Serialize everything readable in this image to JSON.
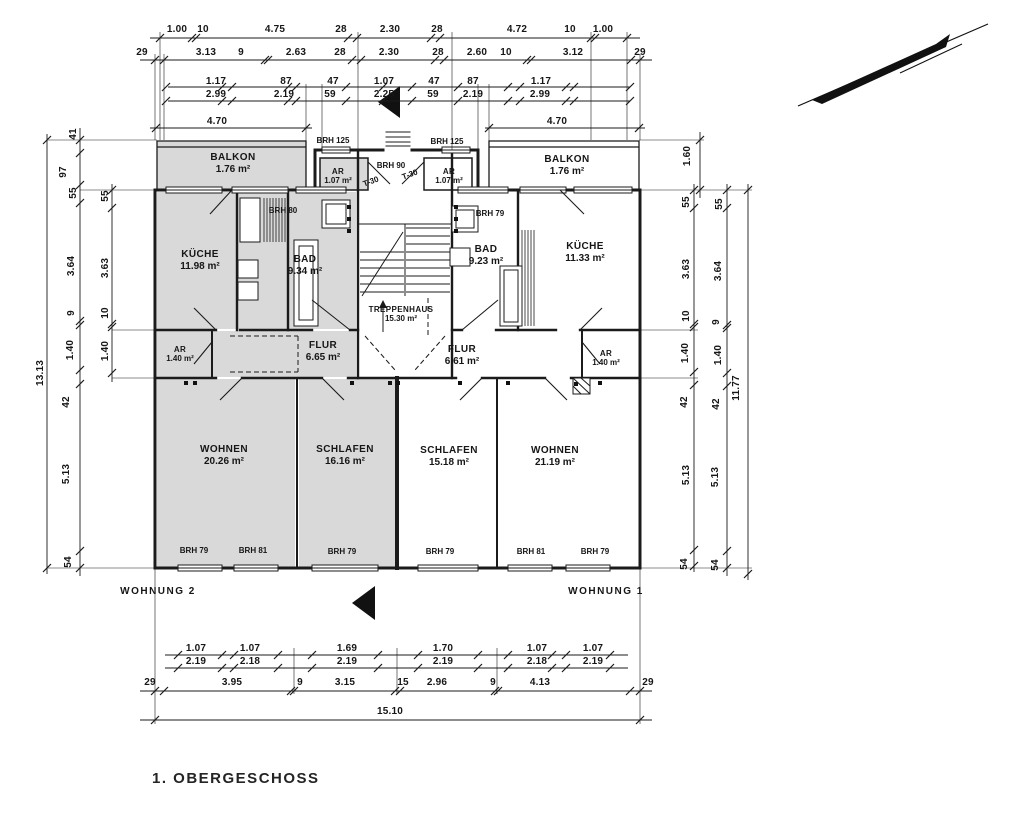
{
  "title": "1. OBERGESCHOSS",
  "colors": {
    "shaded": "#d9d9d9",
    "line": "#1b1b1b",
    "background": "#ffffff"
  },
  "apartment_labels": [
    {
      "text": "WOHNUNG 2",
      "x": 158,
      "y": 592
    },
    {
      "text": "WOHNUNG 1",
      "x": 606,
      "y": 592
    }
  ],
  "rooms": [
    {
      "id": "balkon-left",
      "name": "BALKON",
      "area": "1.76 m²",
      "x": 233,
      "y": 158
    },
    {
      "id": "balkon-right",
      "name": "BALKON",
      "area": "1.76 m²",
      "x": 567,
      "y": 160
    },
    {
      "id": "ar-top-left",
      "name": "AR",
      "area": "1.07 m²",
      "x": 338,
      "y": 170,
      "small": true
    },
    {
      "id": "ar-top-right",
      "name": "AR",
      "area": "1.07 m²",
      "x": 449,
      "y": 170,
      "small": true
    },
    {
      "id": "kueche-left",
      "name": "KÜCHE",
      "area": "11.98 m²",
      "x": 200,
      "y": 255
    },
    {
      "id": "bad-left",
      "name": "BAD",
      "area": "9.34 m²",
      "x": 305,
      "y": 260
    },
    {
      "id": "treppenhaus",
      "name": "TREPPENHAUS",
      "area": "15.30 m²",
      "x": 401,
      "y": 308,
      "small": true
    },
    {
      "id": "bad-right",
      "name": "BAD",
      "area": "9.23 m²",
      "x": 486,
      "y": 250
    },
    {
      "id": "kueche-right",
      "name": "KÜCHE",
      "area": "11.33 m²",
      "x": 585,
      "y": 247
    },
    {
      "id": "ar-mid-left",
      "name": "AR",
      "area": "1.40 m²",
      "x": 180,
      "y": 348,
      "small": true
    },
    {
      "id": "flur-left",
      "name": "FLUR",
      "area": "6.65 m²",
      "x": 323,
      "y": 346
    },
    {
      "id": "flur-right",
      "name": "FLUR",
      "area": "6.61 m²",
      "x": 462,
      "y": 350
    },
    {
      "id": "ar-mid-right",
      "name": "AR",
      "area": "1.40 m²",
      "x": 606,
      "y": 352,
      "small": true
    },
    {
      "id": "wohnen-left",
      "name": "WOHNEN",
      "area": "20.26 m²",
      "x": 224,
      "y": 450
    },
    {
      "id": "schlafen-left",
      "name": "SCHLAFEN",
      "area": "16.16 m²",
      "x": 345,
      "y": 450
    },
    {
      "id": "schlafen-right",
      "name": "SCHLAFEN",
      "area": "15.18 m²",
      "x": 449,
      "y": 451
    },
    {
      "id": "wohnen-right",
      "name": "WOHNEN",
      "area": "21.19 m²",
      "x": 555,
      "y": 451
    }
  ],
  "annotations": [
    {
      "text": "BRH 125",
      "x": 333,
      "y": 141
    },
    {
      "text": "BRH 125",
      "x": 447,
      "y": 142
    },
    {
      "text": "BRH 90",
      "x": 391,
      "y": 166
    },
    {
      "text": "T-30",
      "x": 371,
      "y": 182,
      "r": -20
    },
    {
      "text": "T-30",
      "x": 410,
      "y": 175,
      "r": -20
    },
    {
      "text": "BRH 80",
      "x": 283,
      "y": 211
    },
    {
      "text": "BRH 79",
      "x": 490,
      "y": 214
    },
    {
      "text": "BRH 79",
      "x": 194,
      "y": 551
    },
    {
      "text": "BRH 81",
      "x": 253,
      "y": 551
    },
    {
      "text": "BRH 79",
      "x": 342,
      "y": 552
    },
    {
      "text": "BRH 79",
      "x": 440,
      "y": 552
    },
    {
      "text": "BRH 81",
      "x": 531,
      "y": 552
    },
    {
      "text": "BRH 79",
      "x": 595,
      "y": 552
    }
  ],
  "dim_labels": [
    {
      "t": "1.00",
      "x": 177,
      "y": 30
    },
    {
      "t": "10",
      "x": 203,
      "y": 30
    },
    {
      "t": "4.75",
      "x": 275,
      "y": 30
    },
    {
      "t": "28",
      "x": 341,
      "y": 30
    },
    {
      "t": "2.30",
      "x": 390,
      "y": 30
    },
    {
      "t": "28",
      "x": 437,
      "y": 30
    },
    {
      "t": "4.72",
      "x": 517,
      "y": 30
    },
    {
      "t": "10",
      "x": 570,
      "y": 30
    },
    {
      "t": "1.00",
      "x": 603,
      "y": 30
    },
    {
      "t": "29",
      "x": 142,
      "y": 53
    },
    {
      "t": "3.13",
      "x": 206,
      "y": 53
    },
    {
      "t": "9",
      "x": 241,
      "y": 53
    },
    {
      "t": "2.63",
      "x": 296,
      "y": 53
    },
    {
      "t": "28",
      "x": 340,
      "y": 53
    },
    {
      "t": "2.30",
      "x": 389,
      "y": 53
    },
    {
      "t": "28",
      "x": 438,
      "y": 53
    },
    {
      "t": "2.60",
      "x": 477,
      "y": 53
    },
    {
      "t": "10",
      "x": 506,
      "y": 53
    },
    {
      "t": "3.12",
      "x": 573,
      "y": 53
    },
    {
      "t": "29",
      "x": 640,
      "y": 53
    },
    {
      "t": "1.17",
      "x": 216,
      "y": 82
    },
    {
      "t": "87",
      "x": 286,
      "y": 82
    },
    {
      "t": "47",
      "x": 333,
      "y": 82
    },
    {
      "t": "1.07",
      "x": 384,
      "y": 82
    },
    {
      "t": "47",
      "x": 434,
      "y": 82
    },
    {
      "t": "87",
      "x": 473,
      "y": 82
    },
    {
      "t": "1.17",
      "x": 541,
      "y": 82
    },
    {
      "t": "2.99",
      "x": 216,
      "y": 95
    },
    {
      "t": "2.19",
      "x": 284,
      "y": 95
    },
    {
      "t": "59",
      "x": 330,
      "y": 95
    },
    {
      "t": "2.25",
      "x": 384,
      "y": 95
    },
    {
      "t": "59",
      "x": 433,
      "y": 95
    },
    {
      "t": "2.19",
      "x": 473,
      "y": 95
    },
    {
      "t": "2.99",
      "x": 540,
      "y": 95
    },
    {
      "t": "4.70",
      "x": 217,
      "y": 122
    },
    {
      "t": "4.70",
      "x": 557,
      "y": 122
    },
    {
      "t": "1.07",
      "x": 196,
      "y": 649
    },
    {
      "t": "1.07",
      "x": 250,
      "y": 649
    },
    {
      "t": "1.69",
      "x": 347,
      "y": 649
    },
    {
      "t": "1.70",
      "x": 443,
      "y": 649
    },
    {
      "t": "1.07",
      "x": 537,
      "y": 649
    },
    {
      "t": "1.07",
      "x": 593,
      "y": 649
    },
    {
      "t": "2.19",
      "x": 196,
      "y": 662
    },
    {
      "t": "2.18",
      "x": 250,
      "y": 662
    },
    {
      "t": "2.19",
      "x": 347,
      "y": 662
    },
    {
      "t": "2.19",
      "x": 443,
      "y": 662
    },
    {
      "t": "2.18",
      "x": 537,
      "y": 662
    },
    {
      "t": "2.19",
      "x": 593,
      "y": 662
    },
    {
      "t": "29",
      "x": 150,
      "y": 683
    },
    {
      "t": "3.95",
      "x": 232,
      "y": 683
    },
    {
      "t": "9",
      "x": 300,
      "y": 683
    },
    {
      "t": "3.15",
      "x": 345,
      "y": 683
    },
    {
      "t": "15",
      "x": 403,
      "y": 683
    },
    {
      "t": "2.96",
      "x": 437,
      "y": 683
    },
    {
      "t": "9",
      "x": 493,
      "y": 683
    },
    {
      "t": "4.13",
      "x": 540,
      "y": 683
    },
    {
      "t": "29",
      "x": 648,
      "y": 683
    },
    {
      "t": "15.10",
      "x": 390,
      "y": 712
    },
    {
      "t": "41",
      "x": 74,
      "y": 134,
      "r": -90
    },
    {
      "t": "97",
      "x": 64,
      "y": 172,
      "r": -90
    },
    {
      "t": "55",
      "x": 74,
      "y": 193,
      "r": -90
    },
    {
      "t": "3.64",
      "x": 72,
      "y": 266,
      "r": -90
    },
    {
      "t": "9",
      "x": 72,
      "y": 313,
      "r": -90
    },
    {
      "t": "1.40",
      "x": 71,
      "y": 350,
      "r": -90
    },
    {
      "t": "42",
      "x": 67,
      "y": 402,
      "r": -90
    },
    {
      "t": "5.13",
      "x": 67,
      "y": 474,
      "r": -90
    },
    {
      "t": "54",
      "x": 69,
      "y": 562,
      "r": -90
    },
    {
      "t": "13.13",
      "x": 41,
      "y": 373,
      "r": -90
    },
    {
      "t": "55",
      "x": 106,
      "y": 196,
      "r": -90
    },
    {
      "t": "3.63",
      "x": 106,
      "y": 268,
      "r": -90
    },
    {
      "t": "10",
      "x": 106,
      "y": 313,
      "r": -90
    },
    {
      "t": "1.40",
      "x": 106,
      "y": 351,
      "r": -90
    },
    {
      "t": "1.60",
      "x": 688,
      "y": 156,
      "r": -90
    },
    {
      "t": "55",
      "x": 687,
      "y": 202,
      "r": -90
    },
    {
      "t": "3.63",
      "x": 687,
      "y": 269,
      "r": -90
    },
    {
      "t": "10",
      "x": 687,
      "y": 316,
      "r": -90
    },
    {
      "t": "1.40",
      "x": 686,
      "y": 353,
      "r": -90
    },
    {
      "t": "42",
      "x": 685,
      "y": 402,
      "r": -90
    },
    {
      "t": "5.13",
      "x": 687,
      "y": 475,
      "r": -90
    },
    {
      "t": "54",
      "x": 685,
      "y": 564,
      "r": -90
    },
    {
      "t": "55",
      "x": 720,
      "y": 204,
      "r": -90
    },
    {
      "t": "3.64",
      "x": 719,
      "y": 271,
      "r": -90
    },
    {
      "t": "9",
      "x": 717,
      "y": 322,
      "r": -90
    },
    {
      "t": "1.40",
      "x": 719,
      "y": 355,
      "r": -90
    },
    {
      "t": "42",
      "x": 717,
      "y": 404,
      "r": -90
    },
    {
      "t": "5.13",
      "x": 716,
      "y": 477,
      "r": -90
    },
    {
      "t": "54",
      "x": 716,
      "y": 565,
      "r": -90
    },
    {
      "t": "11.77",
      "x": 737,
      "y": 388,
      "r": -90
    }
  ]
}
